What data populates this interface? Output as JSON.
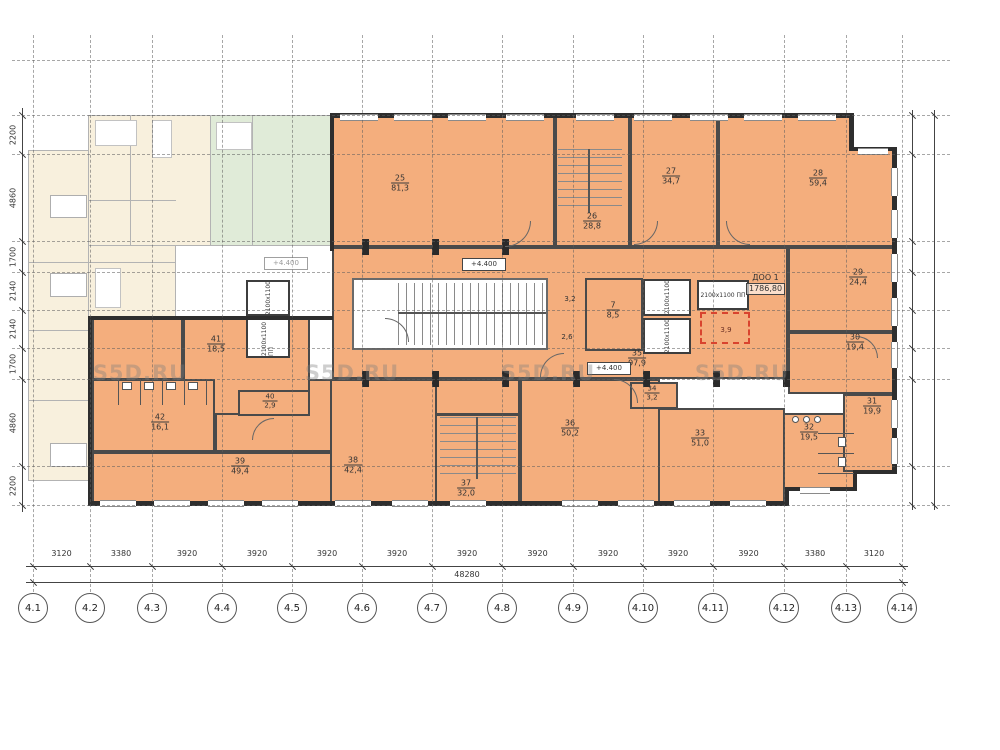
{
  "watermark": {
    "text": "S5D.RU",
    "positions": [
      [
        140,
        373
      ],
      [
        352,
        373
      ],
      [
        548,
        373
      ],
      [
        742,
        373
      ]
    ]
  },
  "colors": {
    "room_fill": "#f4ae7d",
    "wall": "#2e2e2e",
    "ghost_cream": "#f8f0dd",
    "ghost_green": "#e0ebd8",
    "red_dashed": "#d9442f",
    "grid": "#5f5f5f"
  },
  "axes": {
    "labels": [
      "4.1",
      "4.2",
      "4.3",
      "4.4",
      "4.5",
      "4.6",
      "4.7",
      "4.8",
      "4.9",
      "4.10",
      "4.11",
      "4.12",
      "4.13",
      "4.14"
    ],
    "x": [
      33,
      90,
      152,
      222,
      292,
      362,
      432,
      502,
      573,
      643,
      713,
      784,
      846,
      902
    ],
    "bubble_y": 593
  },
  "grid": {
    "hy": [
      115,
      154,
      241,
      272,
      310,
      348,
      379,
      466,
      505
    ],
    "extra_h": [
      60
    ],
    "v_top": 35,
    "v_bottom": 592,
    "h_left": 12,
    "h_right": 950
  },
  "dims": {
    "bottom": {
      "segments": [
        "3120",
        "3380",
        "3920",
        "3920",
        "3920",
        "3920",
        "3920",
        "3920",
        "3920",
        "3920",
        "3920",
        "3380",
        "3120"
      ],
      "total": "48280",
      "line1_y": 566,
      "line2_y": 582,
      "label_y": 549,
      "total_label_x": 467,
      "total_label_y": 570
    },
    "left": {
      "values": [
        "2200",
        "4860",
        "1700",
        "2140",
        "2140",
        "1700",
        "4860",
        "2200"
      ],
      "x": 22
    },
    "right_lines_x": [
      912,
      934
    ]
  },
  "rooms": [
    {
      "num": "25",
      "area": "81,3",
      "x": 332,
      "y": 115,
      "w": 223,
      "h": 132,
      "lx": 400,
      "ly": 183
    },
    {
      "num": "26",
      "area": "28,8",
      "x": 555,
      "y": 115,
      "w": 75,
      "h": 132,
      "lx": 592,
      "ly": 221
    },
    {
      "num": "27",
      "area": "34,7",
      "x": 630,
      "y": 115,
      "w": 88,
      "h": 132,
      "lx": 671,
      "ly": 176
    },
    {
      "num": "28",
      "area": "59,4",
      "x": 718,
      "y": 115,
      "w": 177,
      "h": 132,
      "lx": 818,
      "ly": 178
    },
    {
      "num": "35",
      "area": "97,9",
      "x": 332,
      "y": 247,
      "w": 456,
      "h": 132,
      "lx": 637,
      "ly": 358
    },
    {
      "num": "29",
      "area": "24,4",
      "x": 788,
      "y": 247,
      "w": 107,
      "h": 85,
      "lx": 858,
      "ly": 277
    },
    {
      "num": "30",
      "area": "19,4",
      "x": 788,
      "y": 332,
      "w": 107,
      "h": 62,
      "lx": 855,
      "ly": 342
    },
    {
      "num": "7",
      "area": "8,5",
      "x": 585,
      "y": 278,
      "w": 58,
      "h": 73,
      "lx": 613,
      "ly": 310
    },
    {
      "num": "41",
      "area": "18,5",
      "x": 183,
      "y": 316,
      "w": 127,
      "h": 99,
      "lx": 216,
      "ly": 344
    },
    {
      "num": "42",
      "area": "16,1",
      "x": 92,
      "y": 379,
      "w": 123,
      "h": 73,
      "lx": 160,
      "ly": 422
    },
    {
      "num": "40",
      "area": "2,9",
      "x": 238,
      "y": 390,
      "w": 72,
      "h": 26,
      "lx": 270,
      "ly": 401,
      "small": true
    },
    {
      "num": "39",
      "area": "49,4",
      "x": 92,
      "y": 452,
      "w": 240,
      "h": 53,
      "lx": 240,
      "ly": 466
    },
    {
      "num": "38",
      "area": "42,4",
      "x": 330,
      "y": 379,
      "w": 107,
      "h": 126,
      "lx": 353,
      "ly": 465
    },
    {
      "num": "37",
      "area": "32,0",
      "x": 435,
      "y": 414,
      "w": 85,
      "h": 91,
      "lx": 466,
      "ly": 488
    },
    {
      "num": "36",
      "area": "50,2",
      "x": 520,
      "y": 379,
      "w": 140,
      "h": 126,
      "lx": 570,
      "ly": 428
    },
    {
      "num": "34",
      "area": "3,2",
      "x": 630,
      "y": 382,
      "w": 48,
      "h": 27,
      "lx": 652,
      "ly": 393,
      "small": true
    },
    {
      "num": "33",
      "area": "51,0",
      "x": 658,
      "y": 408,
      "w": 127,
      "h": 97,
      "lx": 700,
      "ly": 438
    },
    {
      "num": "32",
      "area": "19,5",
      "x": 783,
      "y": 413,
      "w": 72,
      "h": 77,
      "lx": 809,
      "ly": 432
    },
    {
      "num": "31",
      "area": "19,9",
      "x": 843,
      "y": 394,
      "w": 54,
      "h": 78,
      "lx": 872,
      "ly": 406
    }
  ],
  "fills": [
    [
      435,
      379,
      85,
      36
    ],
    [
      215,
      379,
      118,
      73
    ],
    [
      92,
      318,
      91,
      62
    ],
    [
      548,
      278,
      38,
      73
    ]
  ],
  "fills_white": [
    [
      853,
      115,
      44,
      33
    ],
    [
      855,
      474,
      42,
      31
    ]
  ],
  "outer_walls": [
    [
      330,
      113,
      523,
      5
    ],
    [
      849,
      113,
      5,
      38
    ],
    [
      849,
      147,
      48,
      4
    ],
    [
      892,
      147,
      5,
      327
    ],
    [
      855,
      470,
      42,
      4
    ],
    [
      853,
      470,
      4,
      21
    ],
    [
      785,
      487,
      72,
      4
    ],
    [
      785,
      487,
      4,
      18
    ],
    [
      88,
      501,
      701,
      5
    ],
    [
      88,
      316,
      4,
      190
    ],
    [
      88,
      316,
      245,
      4
    ],
    [
      330,
      113,
      4,
      138
    ]
  ],
  "windows": {
    "horizontal": [
      [
        340,
        114,
        38
      ],
      [
        394,
        114,
        38
      ],
      [
        448,
        114,
        38
      ],
      [
        506,
        114,
        38
      ],
      [
        576,
        114,
        38
      ],
      [
        634,
        114,
        38
      ],
      [
        690,
        114,
        38
      ],
      [
        744,
        114,
        38
      ],
      [
        798,
        114,
        38
      ],
      [
        858,
        148,
        30
      ],
      [
        100,
        500,
        36
      ],
      [
        154,
        500,
        36
      ],
      [
        208,
        500,
        36
      ],
      [
        262,
        500,
        36
      ],
      [
        335,
        500,
        36
      ],
      [
        392,
        500,
        36
      ],
      [
        450,
        500,
        36
      ],
      [
        562,
        500,
        36
      ],
      [
        618,
        500,
        36
      ],
      [
        674,
        500,
        36
      ],
      [
        730,
        500,
        36
      ],
      [
        800,
        487,
        30
      ]
    ],
    "vertical": [
      [
        891,
        168,
        28
      ],
      [
        891,
        210,
        28
      ],
      [
        891,
        254,
        28
      ],
      [
        891,
        298,
        28
      ],
      [
        891,
        342,
        26
      ],
      [
        891,
        400,
        28
      ],
      [
        891,
        438,
        26
      ],
      [
        862,
        470,
        0
      ]
    ]
  },
  "piers": [
    [
      362,
      371
    ],
    [
      432,
      371
    ],
    [
      502,
      371
    ],
    [
      573,
      371
    ],
    [
      643,
      371
    ],
    [
      713,
      371
    ],
    [
      783,
      371
    ],
    [
      362,
      239
    ],
    [
      432,
      239
    ],
    [
      502,
      239
    ]
  ],
  "elevators": [
    {
      "x": 246,
      "y": 280,
      "w": 44,
      "h": 36,
      "label": "2100х1100",
      "o": "v"
    },
    {
      "x": 246,
      "y": 318,
      "w": 44,
      "h": 40,
      "label": "2100х1100 ПП",
      "o": "v"
    },
    {
      "x": 643,
      "y": 279,
      "w": 48,
      "h": 37,
      "label": "2100х1100",
      "o": "v"
    },
    {
      "x": 643,
      "y": 318,
      "w": 48,
      "h": 36,
      "label": "2100х1100",
      "o": "v"
    },
    {
      "x": 697,
      "y": 280,
      "w": 52,
      "h": 30,
      "label": "2100х1100 ПП",
      "o": "h"
    }
  ],
  "stairs": {
    "lobby": [
      352,
      278,
      196,
      72
    ],
    "mid_treads": [
      398,
      283,
      148,
      62
    ],
    "mid_stringer": [
      398,
      312,
      148,
      2
    ],
    "s26_treads": [
      558,
      149,
      64,
      64
    ],
    "s26_stringer": [
      588,
      149,
      2,
      64
    ],
    "s37_treads": [
      440,
      417,
      76,
      62
    ],
    "s37_stringer": [
      476,
      417,
      2,
      62
    ]
  },
  "red_room": {
    "x": 700,
    "y": 312,
    "w": 50,
    "h": 32,
    "area": "3,9",
    "lx": 726,
    "ly": 330
  },
  "small_areas": [
    {
      "text": "3,2",
      "x": 570,
      "y": 299
    },
    {
      "text": "2,6",
      "x": 567,
      "y": 337
    }
  ],
  "elevation_text": "+4.400",
  "elevations": [
    {
      "x": 462,
      "y": 258,
      "ghost": false
    },
    {
      "x": 587,
      "y": 362,
      "ghost": false
    },
    {
      "x": 264,
      "y": 257,
      "ghost": true
    }
  ],
  "doo": {
    "line1": "ДОО 1",
    "line2": "1786,80"
  },
  "ghost": {
    "rects": [
      [
        28,
        150,
        150,
        330,
        "cream"
      ],
      [
        88,
        115,
        122,
        212,
        "cream"
      ],
      [
        210,
        115,
        122,
        130,
        "green"
      ],
      [
        175,
        245,
        157,
        73,
        "white"
      ]
    ],
    "walls": [
      [
        88,
        115,
        245,
        1
      ],
      [
        88,
        115,
        1,
        203
      ],
      [
        28,
        150,
        61,
        1
      ],
      [
        28,
        150,
        1,
        331
      ],
      [
        28,
        480,
        61,
        1
      ],
      [
        210,
        115,
        1,
        131
      ],
      [
        175,
        245,
        158,
        1
      ],
      [
        175,
        245,
        1,
        74
      ],
      [
        88,
        318,
        88,
        1
      ],
      [
        130,
        115,
        1,
        130
      ],
      [
        88,
        200,
        88,
        1
      ],
      [
        252,
        115,
        1,
        130
      ],
      [
        28,
        262,
        148,
        1
      ],
      [
        28,
        330,
        61,
        1
      ],
      [
        28,
        400,
        61,
        1
      ],
      [
        88,
        245,
        88,
        1
      ]
    ],
    "balconies": [
      [
        50,
        195,
        37,
        23
      ],
      [
        50,
        273,
        37,
        24
      ],
      [
        50,
        443,
        37,
        24
      ]
    ],
    "fixtures": [
      [
        95,
        120,
        42,
        26
      ],
      [
        152,
        120,
        20,
        38
      ],
      [
        216,
        122,
        36,
        28
      ],
      [
        95,
        268,
        26,
        40
      ]
    ]
  },
  "arcs": [
    {
      "x": 505,
      "y": 221,
      "r": 26,
      "c": "br"
    },
    {
      "x": 634,
      "y": 221,
      "r": 24,
      "c": "br"
    },
    {
      "x": 726,
      "y": 221,
      "r": 24,
      "c": "bl"
    },
    {
      "x": 385,
      "y": 318,
      "r": 24,
      "c": "tr"
    },
    {
      "x": 540,
      "y": 353,
      "r": 24,
      "c": "tl"
    },
    {
      "x": 614,
      "y": 379,
      "r": 24,
      "c": "tr"
    },
    {
      "x": 252,
      "y": 418,
      "r": 22,
      "c": "tl"
    },
    {
      "x": 856,
      "y": 336,
      "r": 22,
      "c": "tr"
    }
  ],
  "stalls": {
    "lines": [
      [
        118,
        379,
        1,
        26
      ],
      [
        140,
        379,
        1,
        26
      ],
      [
        162,
        379,
        1,
        26
      ],
      [
        184,
        379,
        1,
        26
      ],
      [
        206,
        379,
        1,
        26
      ],
      [
        818,
        433,
        36,
        1
      ],
      [
        818,
        453,
        36,
        1
      ],
      [
        818,
        473,
        36,
        1
      ]
    ],
    "fixtures": [
      [
        122,
        382,
        10,
        8
      ],
      [
        144,
        382,
        10,
        8
      ],
      [
        166,
        382,
        10,
        8
      ],
      [
        188,
        382,
        10,
        8
      ],
      [
        838,
        437,
        8,
        10
      ],
      [
        838,
        457,
        8,
        10
      ]
    ],
    "circles": [
      [
        792,
        416,
        7
      ],
      [
        803,
        416,
        7
      ],
      [
        814,
        416,
        7
      ]
    ]
  }
}
